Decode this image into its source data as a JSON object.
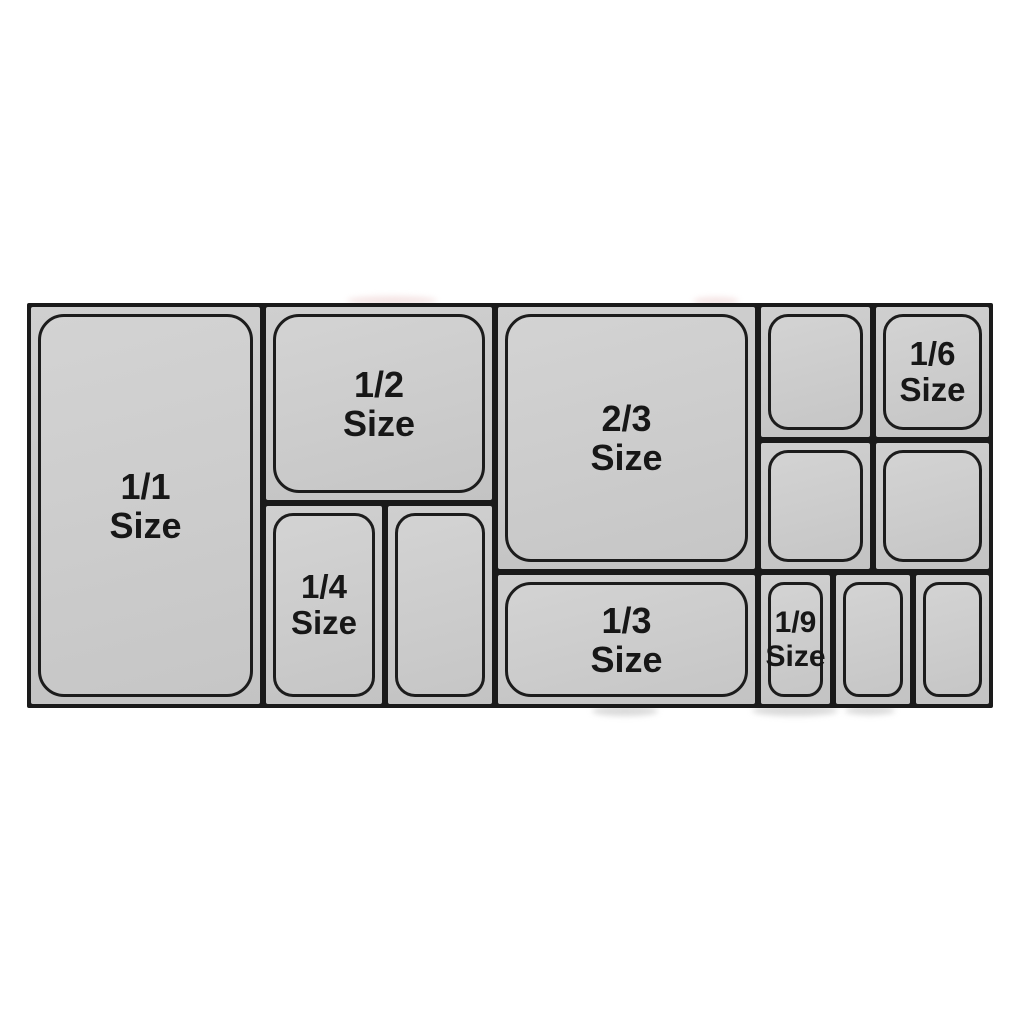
{
  "diagram": {
    "description": "Gastronorm food pan size compatibility chart",
    "colors": {
      "background": "#ffffff",
      "line": "#1a1a1a",
      "pan_fill": "#cccccc",
      "group_fill": "#c8c8c8",
      "text": "#171717"
    },
    "pans": [
      {
        "id": "1-1",
        "fraction": "1/1",
        "word": "Size",
        "labeled": true
      },
      {
        "id": "1-2",
        "fraction": "1/2",
        "word": "Size",
        "labeled": true
      },
      {
        "id": "1-4",
        "fraction": "1/4",
        "word": "Size",
        "labeled": true
      },
      {
        "id": "1-4-unlabeled",
        "fraction": "",
        "word": "",
        "labeled": false
      },
      {
        "id": "2-3",
        "fraction": "2/3",
        "word": "Size",
        "labeled": true
      },
      {
        "id": "1-3",
        "fraction": "1/3",
        "word": "Size",
        "labeled": true
      },
      {
        "id": "1-6-unlabeled-top-left",
        "fraction": "",
        "word": "",
        "labeled": false
      },
      {
        "id": "1-6",
        "fraction": "1/6",
        "word": "Size",
        "labeled": true
      },
      {
        "id": "1-6-unlabeled-mid-left",
        "fraction": "",
        "word": "",
        "labeled": false
      },
      {
        "id": "1-6-unlabeled-mid-right",
        "fraction": "",
        "word": "",
        "labeled": false
      },
      {
        "id": "1-9",
        "fraction": "1/9",
        "word": "Size",
        "labeled": true
      },
      {
        "id": "1-9-unlabeled-mid",
        "fraction": "",
        "word": "",
        "labeled": false
      },
      {
        "id": "1-9-unlabeled-right",
        "fraction": "",
        "word": "",
        "labeled": false
      }
    ]
  }
}
